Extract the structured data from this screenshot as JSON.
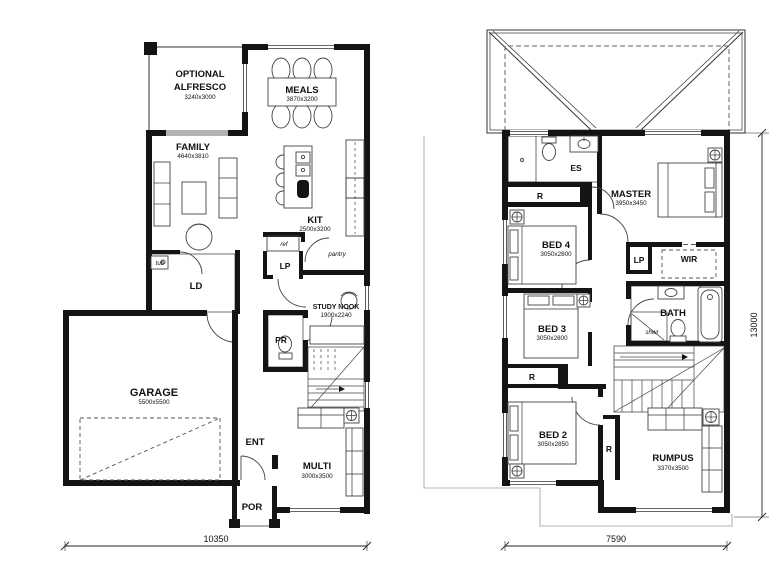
{
  "ground_floor": {
    "alfresco_line1": "OPTIONAL",
    "alfresco_line2": "ALFRESCO",
    "alfresco_size": "3240x3000",
    "meals_label": "MEALS",
    "meals_size": "3870x3200",
    "family_label": "FAMILY",
    "family_size": "4640x3810",
    "kit_label": "KIT",
    "kit_size": "2500x3200",
    "ld_label": "LD",
    "tub_label": "tub",
    "ref_label": "ref",
    "pantry_label": "pantry",
    "lp_label": "LP",
    "study_nook_label": "STUDY NOOK",
    "study_nook_size": "1900x2240",
    "pr_label": "PR",
    "garage_label": "GARAGE",
    "garage_size": "5500x5500",
    "ent_label": "ENT",
    "por_label": "POR",
    "multi_label": "MULTI",
    "multi_size": "3000x3500",
    "width_dimension": "10350"
  },
  "first_floor": {
    "es_label": "ES",
    "master_label": "MASTER",
    "master_size": "3950x3450",
    "robe_label": "R",
    "bed4_label": "BED 4",
    "bed4_size": "3050x2800",
    "lp_label": "LP",
    "wir_label": "WIR",
    "bed3_label": "BED 3",
    "bed3_size": "3050x2800",
    "bath_label": "BATH",
    "shower_label": "shwr",
    "bed2_label": "BED 2",
    "bed2_size": "3050x2850",
    "rumpus_label": "RUMPUS",
    "rumpus_size": "3370x3500",
    "width_dimension": "7590",
    "height_dimension": "13000"
  }
}
